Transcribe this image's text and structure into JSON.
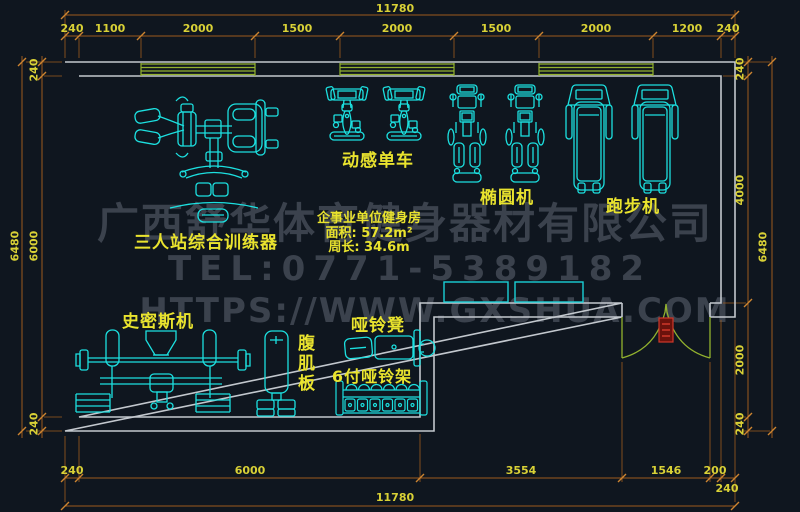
{
  "plan": {
    "room_info": {
      "name": "企事业单位健身房",
      "area": "面积: 57.2m²",
      "perimeter": "周长: 34.6m"
    },
    "watermark": {
      "company": "广西舒华体育健身器材有限公司",
      "tel": "TEL:0771-5389182",
      "url": "HTTPS://WWW.GXSHUA.COM"
    },
    "equipment_labels": {
      "spin_bike": "动感单车",
      "elliptical": "椭圆机",
      "treadmill": "跑步机",
      "multi_station": "三人站综合训练器",
      "smith_machine": "史密斯机",
      "dumbbell_bench": "哑铃凳",
      "ab_board": "腹肌板",
      "dumbbell_rack": "6付哑铃架"
    },
    "dimensions": {
      "top": {
        "total": "11780",
        "segments": [
          "240",
          "1100",
          "2000",
          "1500",
          "2000",
          "1500",
          "2000",
          "1200",
          "240"
        ]
      },
      "bottom": {
        "total": "11780",
        "segments": [
          "240",
          "6000",
          "3554",
          "1546",
          "200",
          "240"
        ]
      },
      "left": {
        "total": "6480",
        "segments": [
          "240",
          "6000",
          "240"
        ]
      },
      "right": {
        "total": "6480",
        "segments": [
          "240",
          "4000",
          "2000",
          "240"
        ]
      }
    },
    "colors": {
      "background": "#0f161f",
      "wall": "#c3c8ce",
      "equipment": "#1ce0e0",
      "dimension_line": "#9e5b1e",
      "dimension_text": "#d9d136",
      "label_text": "#e9e32e",
      "window_door": "#93b22e",
      "door_marker": "#cf382a",
      "watermark": "#3b424d"
    }
  }
}
